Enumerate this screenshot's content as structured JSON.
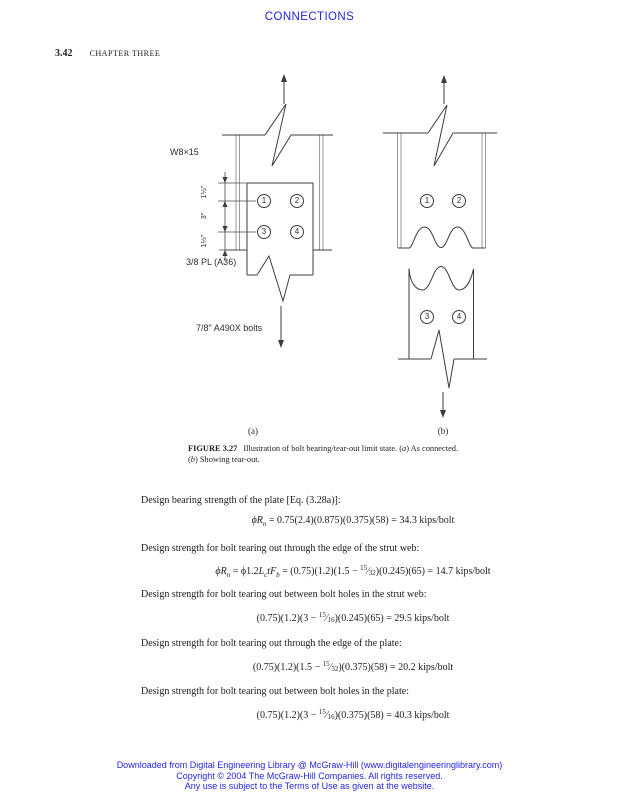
{
  "page": {
    "background": "#ffffff",
    "accent_blue": "#2424dd",
    "ink": "#1f1f1f"
  },
  "header": {
    "running_title": "CONNECTIONS",
    "page_number": "3.42",
    "chapter": "CHAPTER THREE"
  },
  "figure": {
    "beam_label": "W8×15",
    "plate_label": "3/8 PL (A36)",
    "bolts_label": "7/8\" A490X bolts",
    "dim_top": "1½\"",
    "dim_mid": "3\"",
    "dim_bottom": "1½\"",
    "sublabel_a": "(a)",
    "sublabel_b": "(b)",
    "bolt_numbers": [
      "1",
      "2",
      "3",
      "4"
    ]
  },
  "caption": {
    "label": "FIGURE 3.27",
    "l1a": "Illustration of bolt bearing/tear-out limit state. (",
    "l1b": "a",
    "l1c": ") As connected.",
    "l2a": "(",
    "l2b": "b",
    "l2c": ") Showing tear-out."
  },
  "body": {
    "p1": "Design bearing strength of the plate [Eq. (3.28a)]:",
    "p2": "Design strength for bolt tearing out through the edge of the strut web:",
    "p3": "Design strength for bolt tearing out between bolt holes in the strut web:",
    "p4": "Design strength for bolt tearing out through the edge of the plate:",
    "p5": "Design strength for bolt tearing out between bolt holes in the plate:",
    "eq1": {
      "phi_R": "ϕR",
      "sub_n": "n",
      "rest": " = 0.75(2.4)(0.875)(0.375)(58) = 34.3 kips/bolt"
    },
    "eq2": {
      "phi_R": "ϕR",
      "sub_n": "n",
      "mid1": " = ϕ1.2",
      "L": "L",
      "sub_c": "c",
      "t": "t",
      "F": "F",
      "sub_b": "b",
      "mid2": " = (0.75)(1.2)(1.5 − ",
      "num": "15",
      "slash": "⁄",
      "den": "32",
      "rest": ")(0.245)(65) = 14.7 kips/bolt"
    },
    "eq3": {
      "pre": "(0.75)(1.2)(3 − ",
      "num": "15",
      "slash": "⁄",
      "den": "16",
      "rest": ")(0.245)(65) = 29.5 kips/bolt"
    },
    "eq4": {
      "pre": "(0.75)(1.2)(1.5 − ",
      "num": "15",
      "slash": "⁄",
      "den": "32",
      "rest": ")(0.375)(58) = 20.2 kips/bolt"
    },
    "eq5": {
      "pre": "(0.75)(1.2)(3 − ",
      "num": "15",
      "slash": "⁄",
      "den": "16",
      "rest": ")(0.375)(58) = 40.3 kips/bolt"
    }
  },
  "footer": {
    "line1": "Downloaded from Digital Engineering Library @ McGraw-Hill (www.digitalengineeringlibrary.com)",
    "line2": "Copyright © 2004 The McGraw-Hill Companies. All rights reserved.",
    "line3": "Any use is subject to the Terms of Use as given at the website."
  }
}
